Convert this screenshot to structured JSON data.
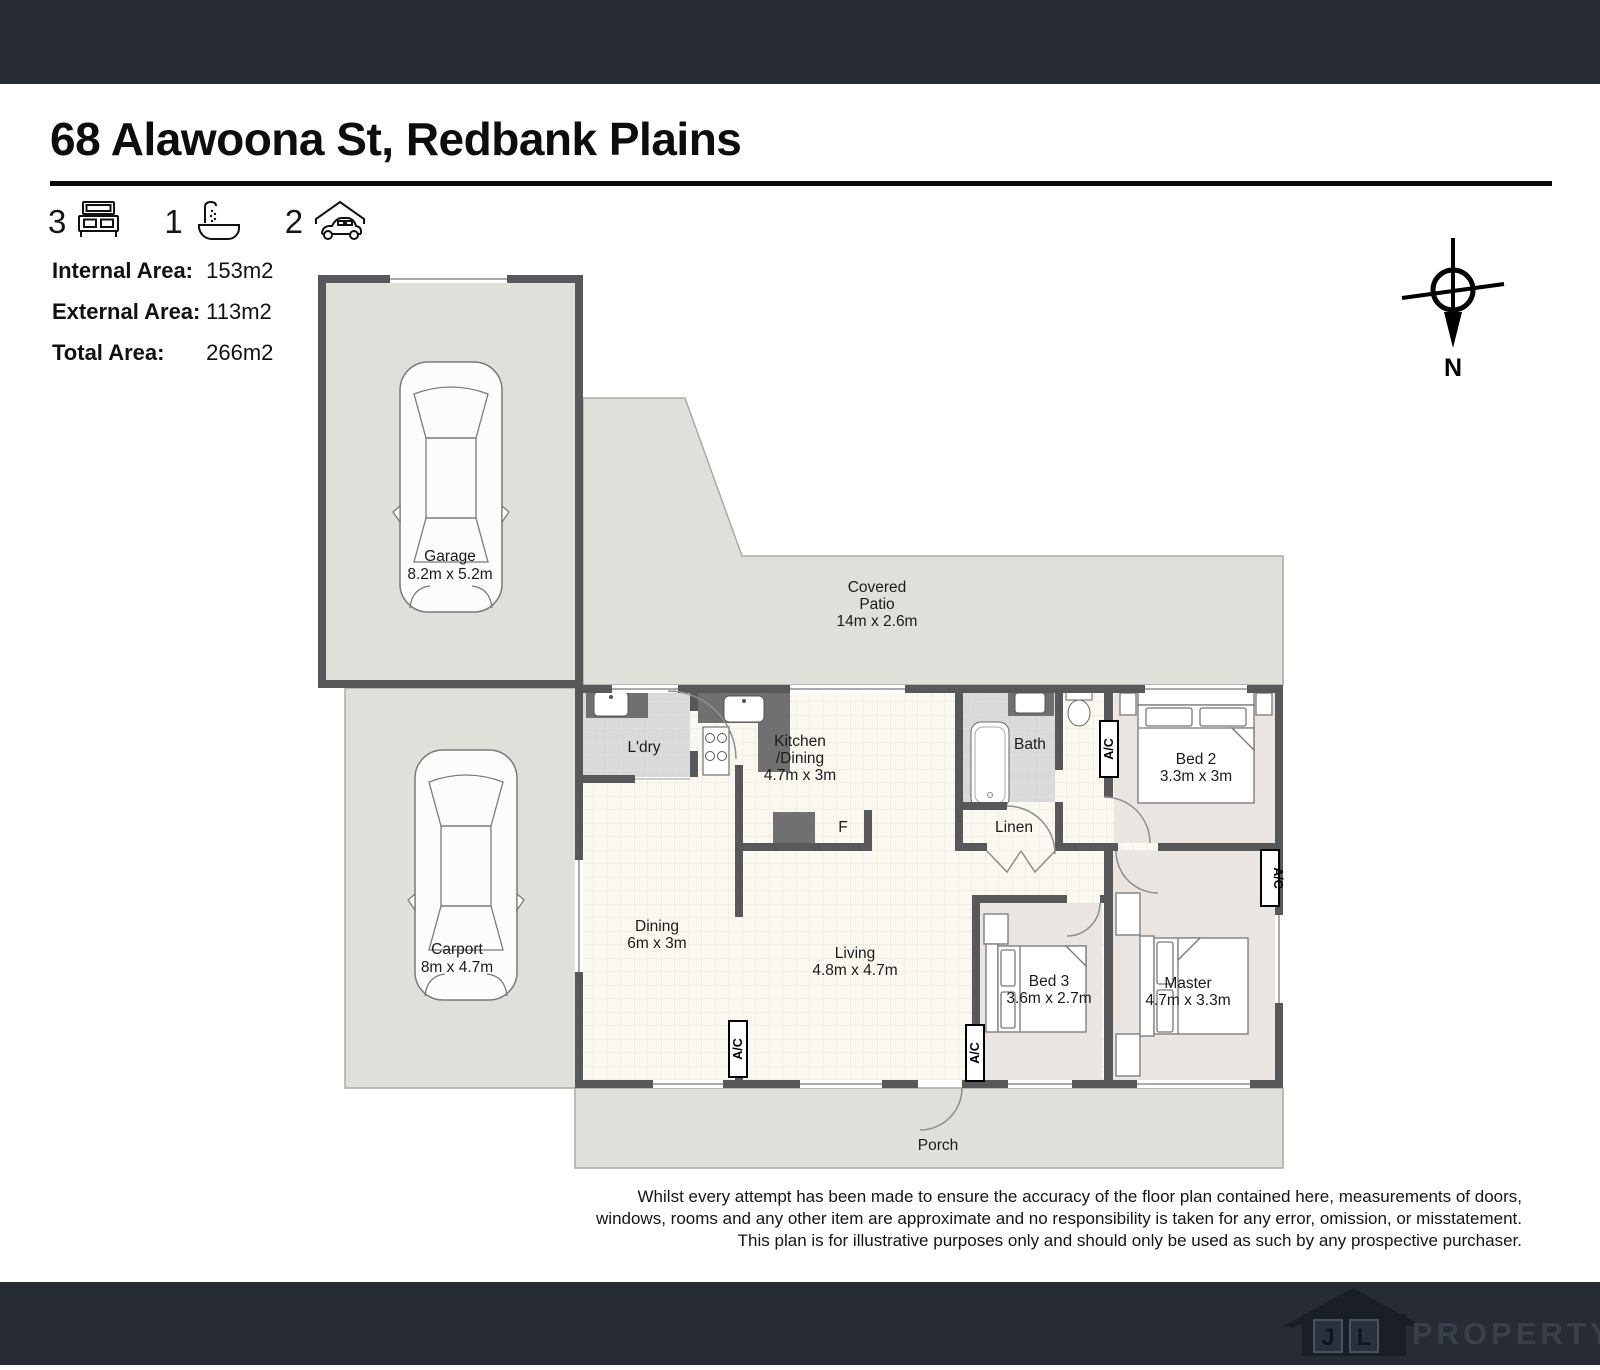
{
  "header": {
    "title": "68 Alawoona St, Redbank Plains",
    "features": [
      {
        "count": "3",
        "icon": "bed-icon"
      },
      {
        "count": "1",
        "icon": "bath-icon"
      },
      {
        "count": "2",
        "icon": "car-icon"
      }
    ]
  },
  "stats": [
    {
      "label": "Internal Area:",
      "value": "153m2"
    },
    {
      "label": "External Area:",
      "value": "113m2"
    },
    {
      "label": "Total Area:",
      "value": "266m2"
    }
  ],
  "compass": {
    "north_label": "N"
  },
  "rooms": {
    "garage": {
      "name": "Garage",
      "dims": "8.2m x 5.2m"
    },
    "carport": {
      "name": "Carport",
      "dims": "8m x 4.7m"
    },
    "patio": {
      "line1": "Covered",
      "line2": "Patio",
      "dims": "14m x 2.6m"
    },
    "laundry": {
      "name": "L'dry"
    },
    "kitchen": {
      "line1": "Kitchen",
      "line2": "/Dining",
      "dims": "4.7m x 3m"
    },
    "fridge": {
      "name": "F"
    },
    "bath": {
      "name": "Bath"
    },
    "linen": {
      "name": "Linen"
    },
    "bed2": {
      "name": "Bed 2",
      "dims": "3.3m x 3m"
    },
    "dining": {
      "name": "Dining",
      "dims": "6m x 3m"
    },
    "living": {
      "name": "Living",
      "dims": "4.8m x 4.7m"
    },
    "bed3": {
      "name": "Bed 3",
      "dims": "3.6m x 2.7m"
    },
    "master": {
      "name": "Master",
      "dims": "4.7m x 3.3m"
    },
    "porch": {
      "name": "Porch"
    }
  },
  "ac_label": "A/C",
  "disclaimer": {
    "line1": "Whilst every attempt has been made to ensure the accuracy of the floor plan contained here, measurements of doors,",
    "line2": "windows, rooms and any other item are approximate and no responsibility is taken for any error, omission, or misstatement.",
    "line3": "This plan is for illustrative purposes only and should only be used as such by any prospective purchaser."
  },
  "footer": {
    "logo_letter_1": "J",
    "logo_letter_2": "L",
    "logo_text": "PROPERTY"
  },
  "colors": {
    "bar": "#262b34",
    "wall": "#56585a",
    "exterior": "#dfe0d9",
    "bedroom_floor": "#eae5e0"
  }
}
